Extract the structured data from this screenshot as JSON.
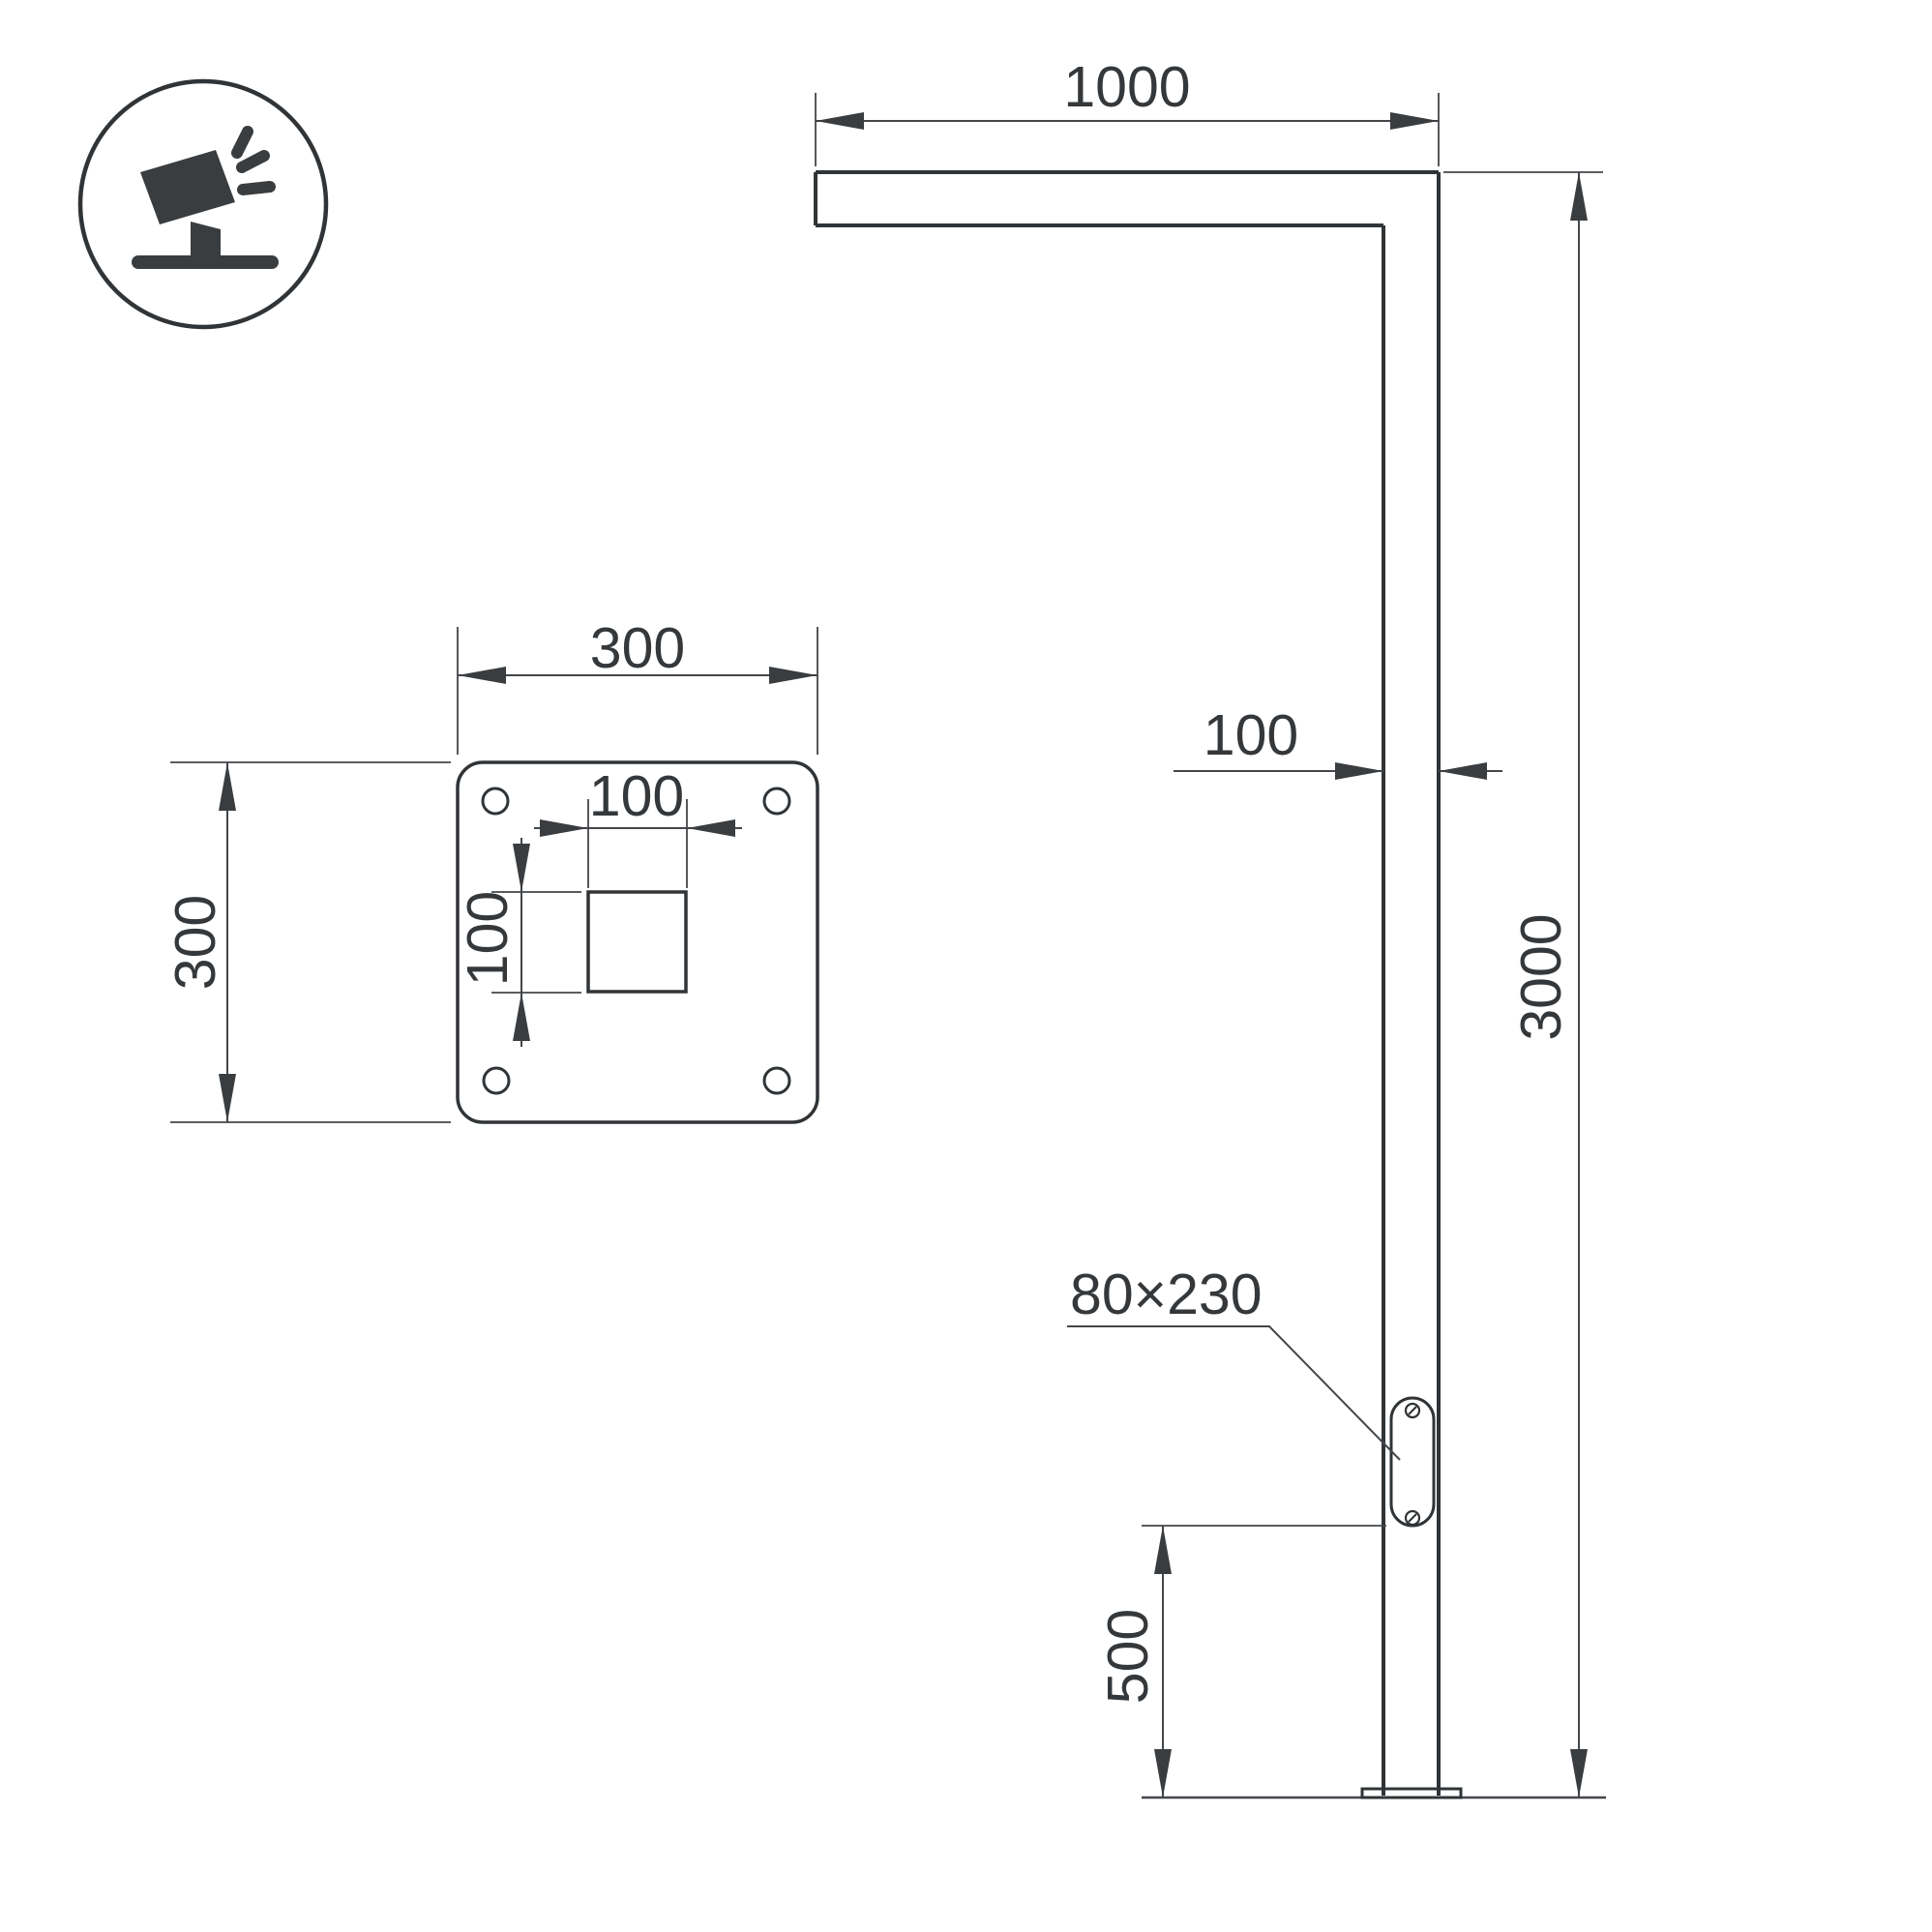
{
  "drawing": {
    "title": "street-light-pole-dimension-drawing",
    "background_color": "#ffffff",
    "object_line_color": "#303437",
    "dimension_line_color": "#43464a",
    "text_color": "#35383b",
    "badge": {
      "icon": "tilted-floodlight-icon"
    },
    "pole_view": {
      "arm_length_label": "1000",
      "pole_width_label": "100",
      "pole_height_label": "3000",
      "access_panel_label": "80×230",
      "panel_bottom_offset_label": "500"
    },
    "plate_view": {
      "plate_width_label": "300",
      "plate_height_label": "300",
      "cutout_width_label": "100",
      "cutout_height_label": "100"
    }
  }
}
